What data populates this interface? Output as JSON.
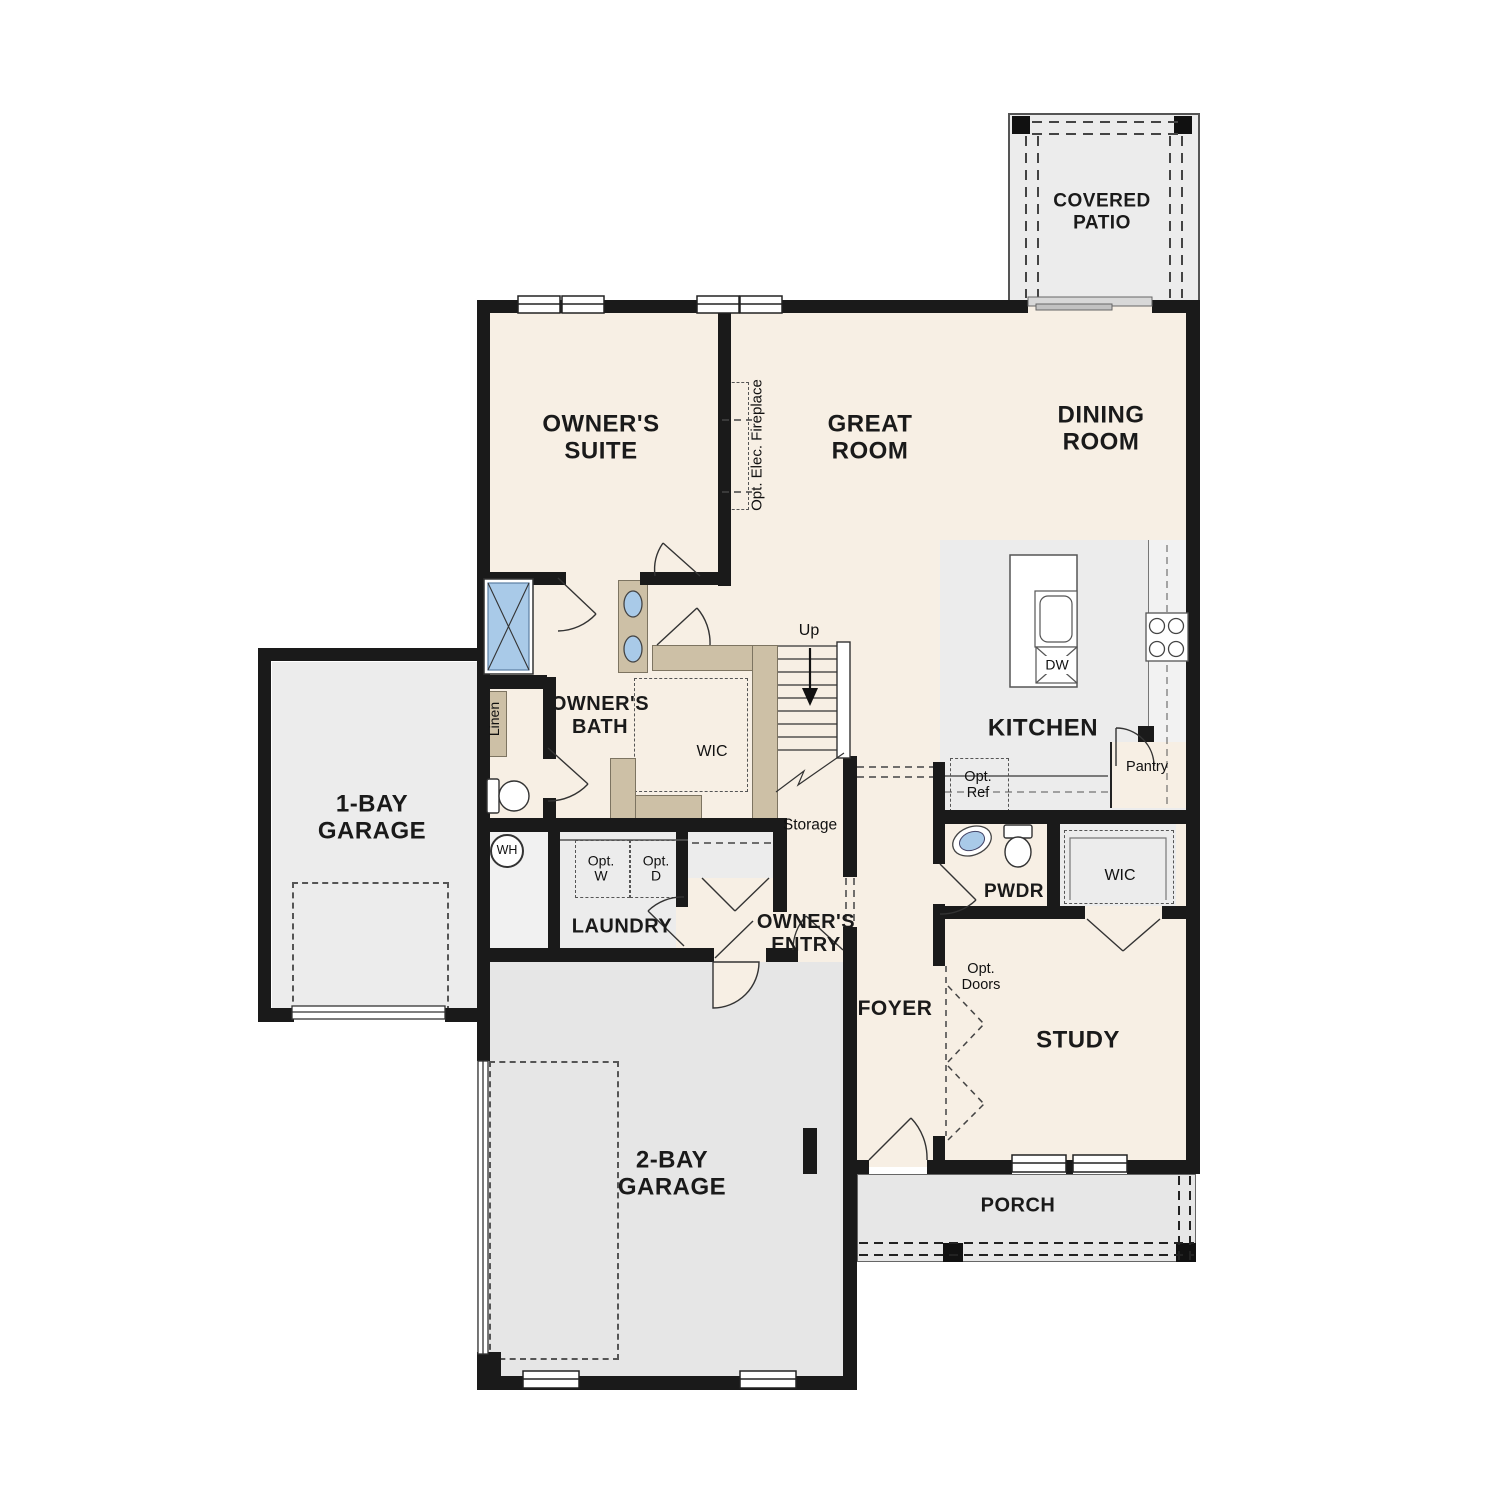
{
  "labels": {
    "covered_patio": "COVERED PATIO",
    "owners_suite": "OWNER'S SUITE",
    "great_room": "GREAT ROOM",
    "dining_room": "DINING ROOM",
    "kitchen": "KITCHEN",
    "dw": "DW",
    "pantry": "Pantry",
    "opt_ref": "Opt. Ref",
    "opt_elec_fireplace": "Opt. Elec. Fireplace",
    "owners_bath": "OWNER'S BATH",
    "linen": "Linen",
    "wic_owners": "WIC",
    "up": "Up",
    "storage": "Storage",
    "wh": "WH",
    "laundry": "LAUNDRY",
    "opt_w": "Opt. W",
    "opt_d": "Opt. D",
    "owners_entry": "OWNER'S ENTRY",
    "one_bay_garage": "1-BAY GARAGE",
    "two_bay_garage": "2-BAY GARAGE",
    "foyer": "FOYER",
    "pwdr": "PWDR",
    "wic_study": "WIC",
    "study": "STUDY",
    "opt_doors": "Opt. Doors",
    "porch": "PORCH"
  },
  "palette": {
    "room_beige": "#f7efe4",
    "room_gray": "#ececec",
    "garage_gray": "#e6e6e6",
    "counter_tan": "#cdc0a6",
    "fixture_blue": "#a9cae8",
    "wall_black": "#1a1a1a",
    "line_gray": "#555555",
    "text": "#111111"
  }
}
